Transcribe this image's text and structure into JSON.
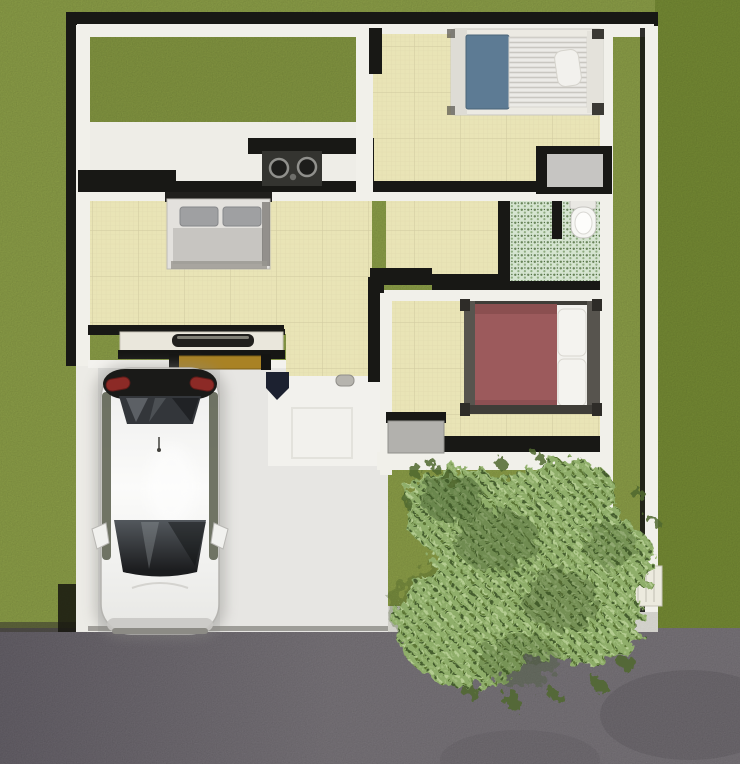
{
  "scene": {
    "width": 740,
    "height": 764,
    "view": "top-down-house-floor-plan-render"
  },
  "palette": {
    "grass": "#8da144",
    "grass_courtyard": "#84983d",
    "hedge": "#758c2f",
    "road": "#706b71",
    "curb": "#c9c8c1",
    "wall_white": "#f1f0ea",
    "wall_black": "#181815",
    "floor_white": "#eeede7",
    "slab": "#dcdcd9",
    "slab_light": "#e7e6e3",
    "patio": "#f2f1ed",
    "tile": "#e9e4b6",
    "mosaic": "#d5e4d0",
    "mosaic_dark": "#69855a",
    "mosaic_mid": "#8fac80",
    "stove": "#343430",
    "bed_blue": "#5d7b94",
    "mattress": "#ecebe7",
    "mattress_stripe": "#c9c7c1",
    "pillow_white": "#f2f1ed",
    "bed_gray_frame": "#e3e1dd",
    "bed_gray_pillow": "#9fa0a2",
    "bed_gray_blanket": "#c7c5c1",
    "bed_red": "#9c5a5c",
    "bed_frame_dark": "#57544e",
    "mat_gray": "#c6c5c2",
    "cabinet": "#b2b1ad",
    "bench": "#a98224",
    "table_top": "#eae7dc",
    "tray": "#21201d",
    "toilet": "#f6f6f3",
    "bush": "#8fae6b",
    "leaf_dark": "#41592a",
    "leaf_light": "#b7ce94",
    "car_glass": "#33363a",
    "taillight": "#8c2a26",
    "car_side": "#4e5340",
    "gate": "#eceade"
  }
}
